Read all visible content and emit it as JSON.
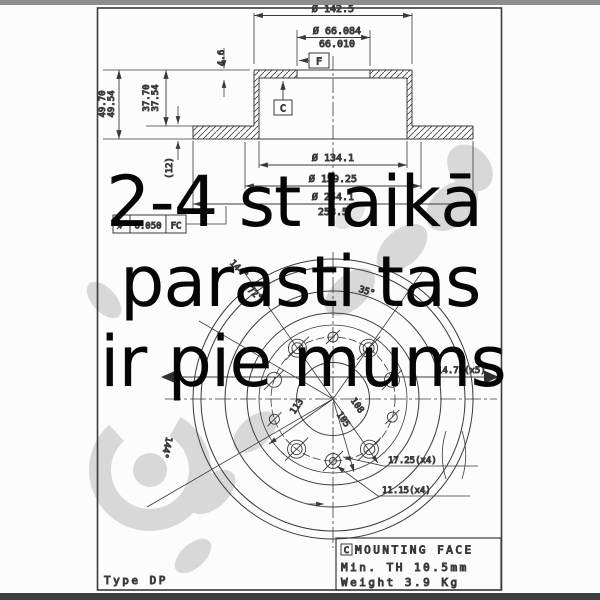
{
  "overlay": {
    "line1": "2-4 st laikā",
    "line2": "parasti tas",
    "line3": "ir pie mums"
  },
  "section": {
    "dim_hat_od": "Ø 142.5",
    "dim_bore_max": "Ø 66.084",
    "dim_bore_min": "66.010",
    "dim_pad_height": "4.6",
    "datum_f": "F",
    "datum_c": "C",
    "dim_height_max": "49.70",
    "dim_height_min": "49.54",
    "dim_hat_height_max": "37.70",
    "dim_hat_height_min": "37.54",
    "dim_thickness": "(12)",
    "dim_recess": "Ø 134.1",
    "dim_mid": "Ø 159.25",
    "dim_od_max": "Ø 254.1",
    "dim_od_min": "253.5",
    "tolerance_value": "0.050",
    "tolerance_datum": "FC"
  },
  "front": {
    "angle_top_left": "144°",
    "angle_left": "72°",
    "angle_right": "35°",
    "angle_lower_left": "144°",
    "pcd_a": "113",
    "pcd_b": "108",
    "pcd_c": "105",
    "holes_mid": "14.75(x5)",
    "holes_large": "17.25(x4)",
    "holes_small": "11.15(x4)"
  },
  "title_block": {
    "datum_ref": "C",
    "line1": "MOUNTING FACE",
    "line2": "Min. TH 10.5mm",
    "line3": "Weight  3.9 Kg"
  },
  "footer": {
    "type_label": "Type DP"
  },
  "colors": {
    "ink": "#3a3a3a",
    "watermark": "#d8d8d8",
    "overlay_text": "#060606"
  }
}
